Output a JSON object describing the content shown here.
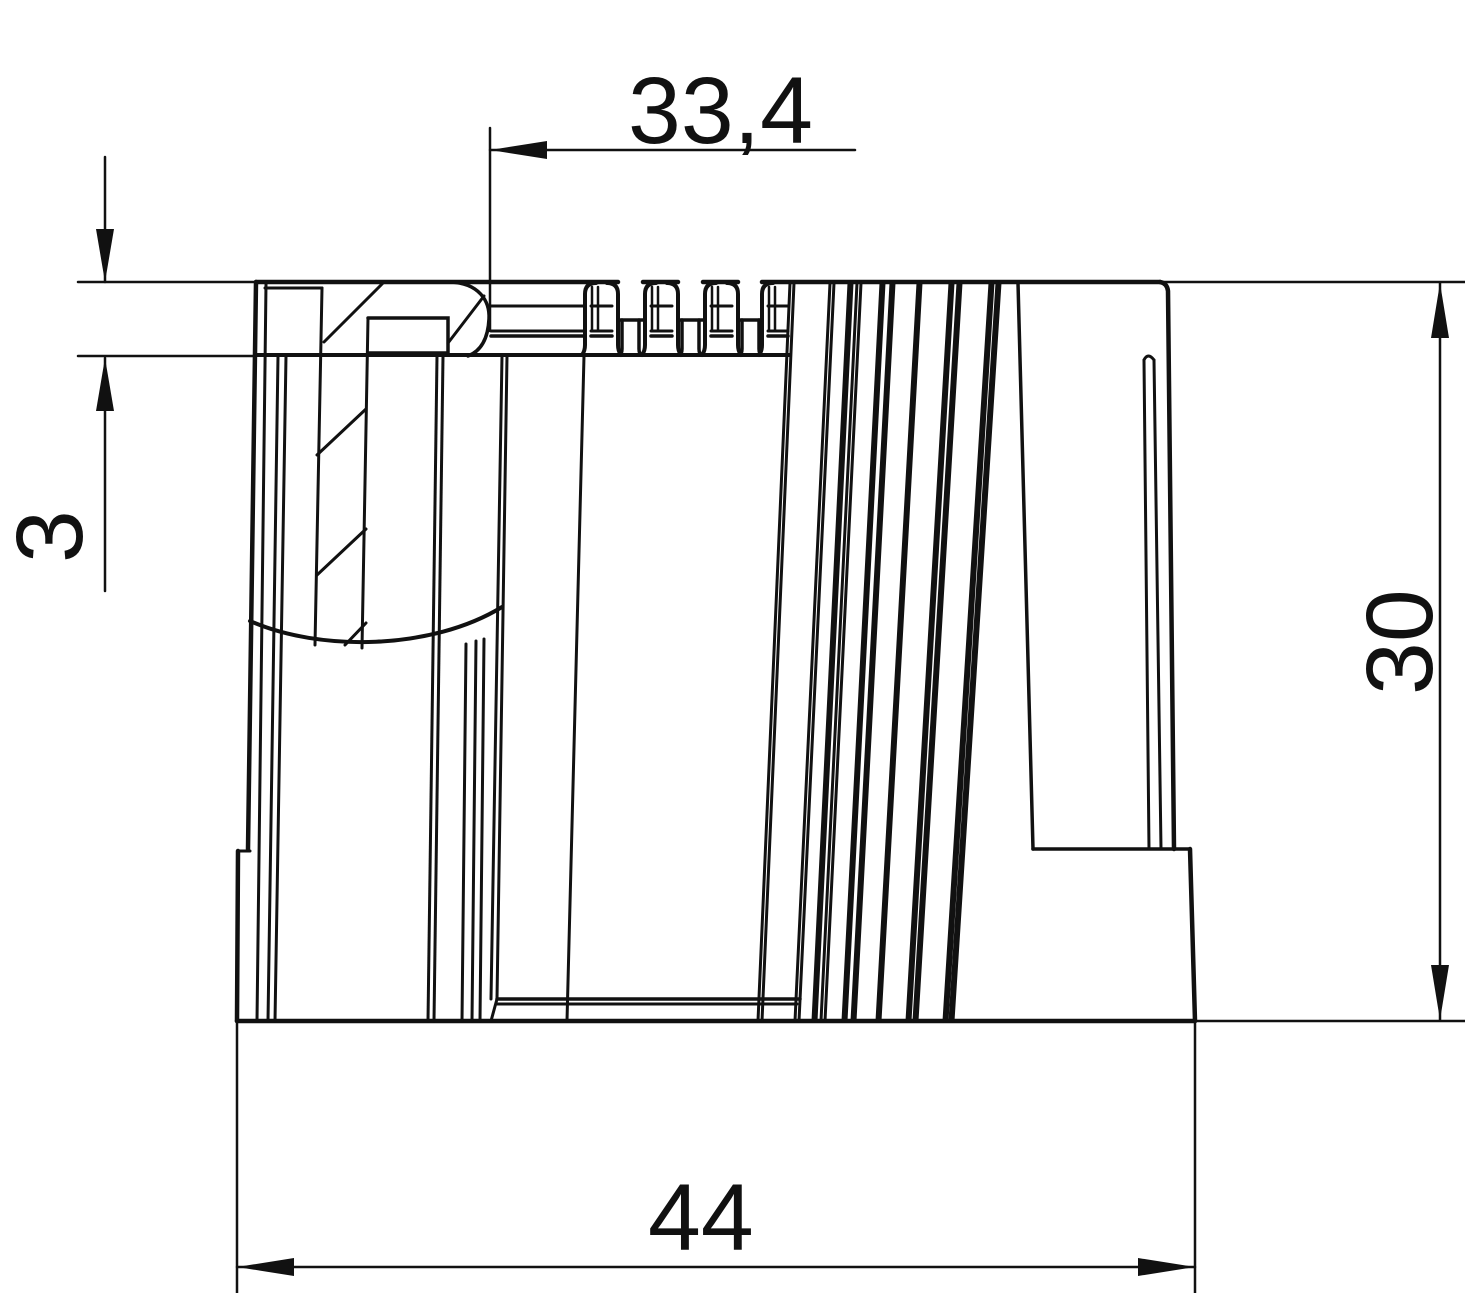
{
  "drawing": {
    "type": "technical-dimension-drawing",
    "part": "ribbed end sleeve / pipe cap side view",
    "background_color": "#ffffff",
    "line_color": "#111111",
    "dimensions": {
      "top_offset": {
        "label": "33,4",
        "orientation": "horizontal"
      },
      "lip_thickness": {
        "label": "3",
        "orientation": "vertical"
      },
      "body_height": {
        "label": "30",
        "orientation": "vertical"
      },
      "total_width": {
        "label": "44",
        "orientation": "horizontal"
      }
    }
  }
}
